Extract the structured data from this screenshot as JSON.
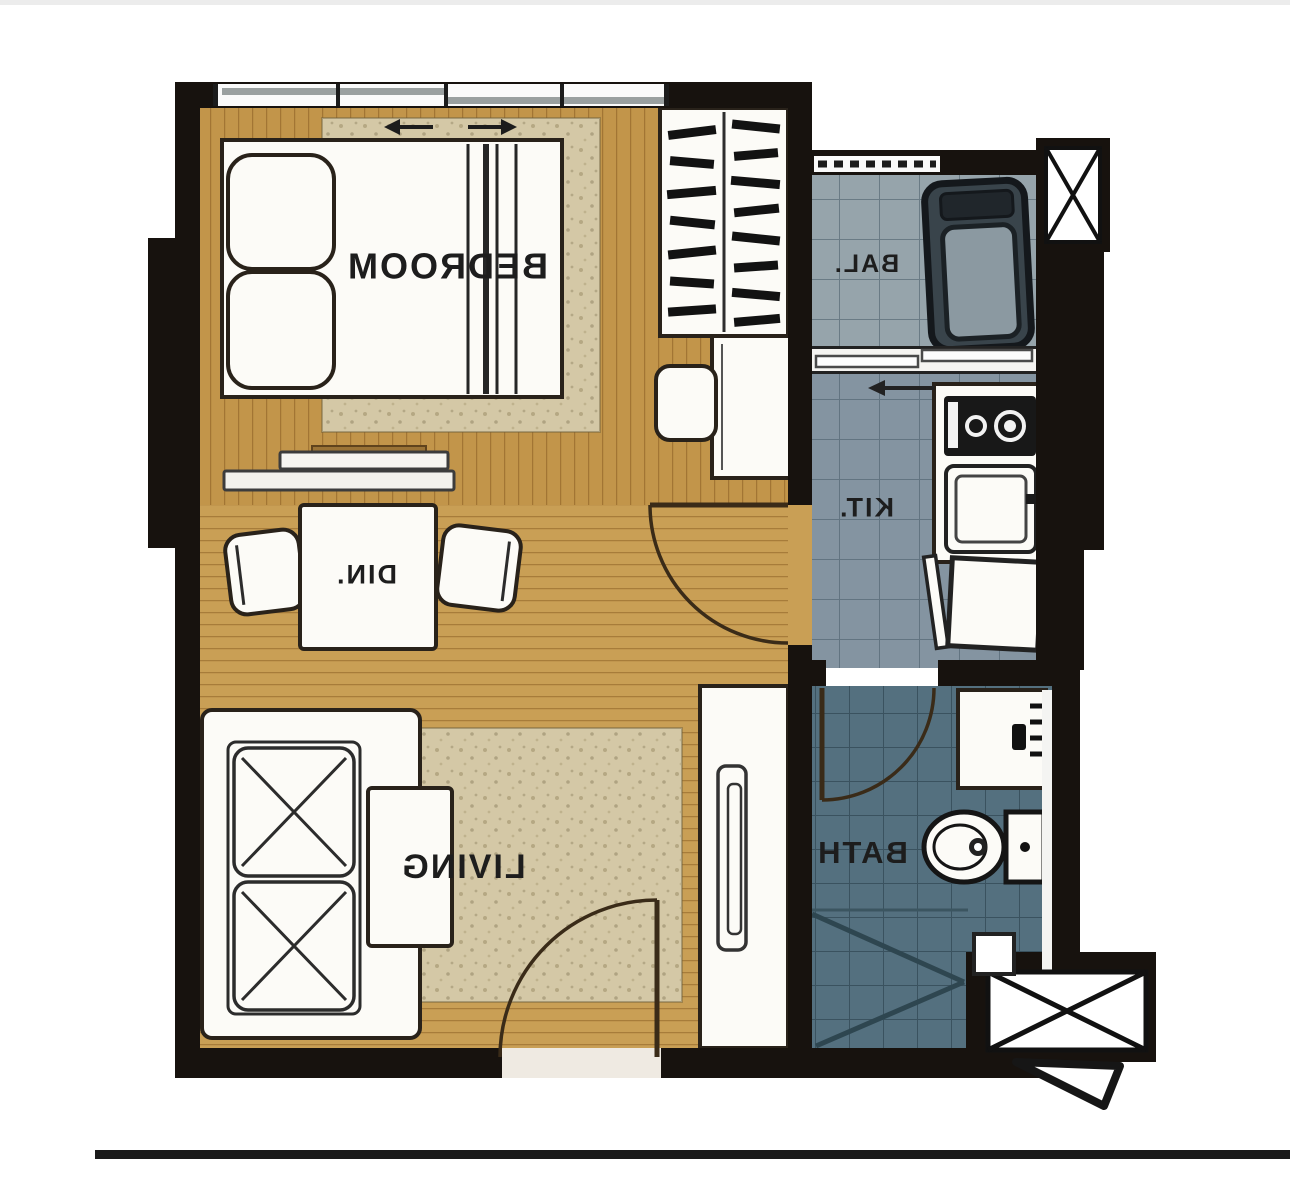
{
  "rooms": {
    "bedroom": {
      "label": "BEDROOM"
    },
    "dining": {
      "label": "DIN."
    },
    "living": {
      "label": "LIVING"
    },
    "kitchen": {
      "label": "KIT."
    },
    "balcony": {
      "label": "BAL."
    },
    "bath": {
      "label": "BATH"
    }
  },
  "colors": {
    "wall": "#17120e",
    "wood_bedroom": "#c2954a",
    "wood_living": "#c99f55",
    "tile_balcony": "#96a4ab",
    "tile_kitchen": "#8494a1",
    "tile_bath": "#54707f",
    "rug": "#d4c8a6",
    "label": "#1d1d1d",
    "door": "#3a2b18",
    "photo_line": "#1a1a1a"
  }
}
